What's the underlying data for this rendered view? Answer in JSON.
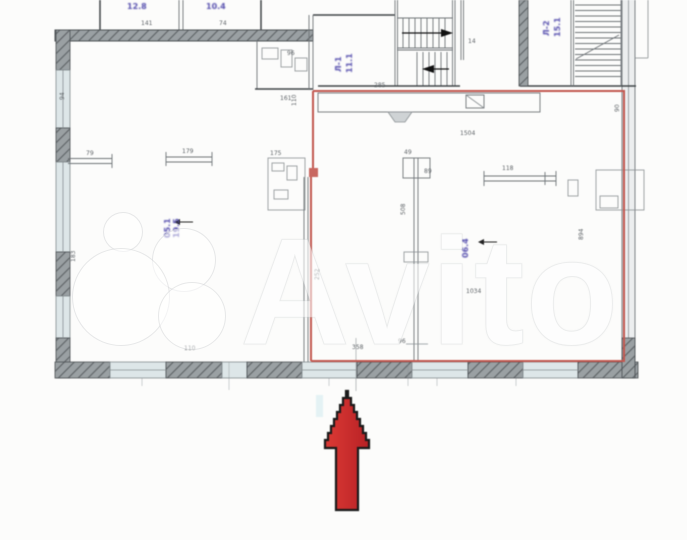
{
  "colors": {
    "paper": "#fcfcfb",
    "wall": "#3f4447",
    "thin": "#6f7478",
    "hatch_bg": "#9aa0a3",
    "hatch_ln": "#5d6265",
    "window": "#dde6e8",
    "red": "#c2574f",
    "purple": "#564fae",
    "dim": "#5f6468",
    "cyan": "#cfe9ef",
    "arrow_fill_light": "#dc3a35",
    "arrow_fill_dark": "#b82125",
    "arrow_outline": "#1b1b1b",
    "watermark": "#ffffff"
  },
  "watermark": {
    "brand": "Avito"
  },
  "plan": {
    "room_labels": [
      {
        "text": "12.8",
        "x": 127,
        "y": 2
      },
      {
        "text": "10.4",
        "x": 206,
        "y": 2
      },
      {
        "text": "Л-1",
        "x": 334,
        "y": 72,
        "rot": -90
      },
      {
        "text": "11.1",
        "x": 345,
        "y": 73,
        "rot": -90
      },
      {
        "text": "Л-2",
        "x": 542,
        "y": 36,
        "rot": -90
      },
      {
        "text": "15.1",
        "x": 553,
        "y": 37,
        "rot": -90
      },
      {
        "text": "05.1",
        "x": 163,
        "y": 238,
        "rot": -90
      },
      {
        "text": "19.5",
        "x": 172,
        "y": 238,
        "rot": -90
      },
      {
        "text": "06.4",
        "x": 461,
        "y": 258,
        "rot": -90
      }
    ],
    "dim_labels": [
      {
        "text": "141",
        "x": 141,
        "y": 20
      },
      {
        "text": "74",
        "x": 219,
        "y": 20
      },
      {
        "text": "96",
        "x": 287,
        "y": 50
      },
      {
        "text": "161",
        "x": 280,
        "y": 95
      },
      {
        "text": "110",
        "x": 291,
        "y": 106,
        "rot": -90
      },
      {
        "text": "285",
        "x": 374,
        "y": 82
      },
      {
        "text": "14",
        "x": 468,
        "y": 38
      },
      {
        "text": "1504",
        "x": 460,
        "y": 130
      },
      {
        "text": "94",
        "x": 59,
        "y": 100,
        "rot": -90
      },
      {
        "text": "79",
        "x": 86,
        "y": 150
      },
      {
        "text": "179",
        "x": 182,
        "y": 148
      },
      {
        "text": "175",
        "x": 270,
        "y": 150
      },
      {
        "text": "49",
        "x": 404,
        "y": 149
      },
      {
        "text": "89",
        "x": 424,
        "y": 168
      },
      {
        "text": "118",
        "x": 502,
        "y": 165
      },
      {
        "text": "508",
        "x": 400,
        "y": 215,
        "rot": -90
      },
      {
        "text": "894",
        "x": 578,
        "y": 240,
        "rot": -90
      },
      {
        "text": "183",
        "x": 70,
        "y": 262,
        "rot": -90
      },
      {
        "text": "252",
        "x": 314,
        "y": 280,
        "rot": -90
      },
      {
        "text": "90",
        "x": 614,
        "y": 112,
        "rot": -90
      },
      {
        "text": "1034",
        "x": 466,
        "y": 288
      },
      {
        "text": "110",
        "x": 184,
        "y": 345
      },
      {
        "text": "358",
        "x": 352,
        "y": 344
      },
      {
        "text": "96",
        "x": 398,
        "y": 338
      }
    ]
  }
}
